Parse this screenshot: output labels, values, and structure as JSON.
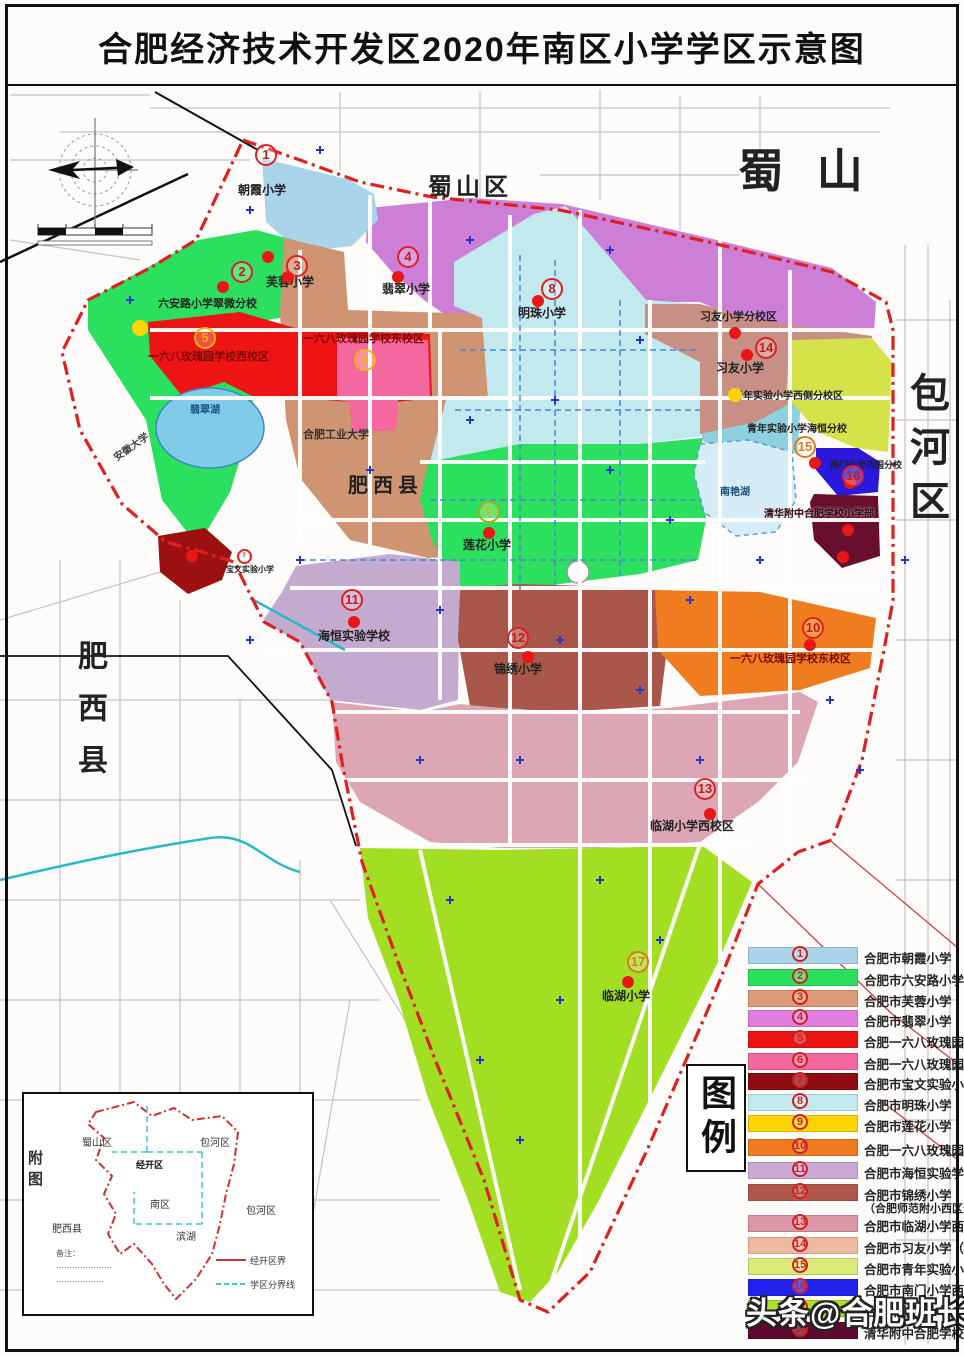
{
  "title": "合肥经济技术开发区2020年南区小学学区示意图",
  "watermark": "头条@合肥班长",
  "districts": {
    "shushan_center": "蜀山区",
    "shushan_big": "蜀 山",
    "baohe_vertical": "包河区",
    "feixi_vertical": "肥西县",
    "feixi_center": "肥西县"
  },
  "legend": {
    "box_label": "图例",
    "items": [
      {
        "num": 1,
        "color": "#a9d4ea",
        "name": "合肥市朝霞小学"
      },
      {
        "num": 2,
        "color": "#2be05e",
        "name": "合肥市六安路小学翠微分校"
      },
      {
        "num": 3,
        "color": "#dd9b79",
        "name": "合肥市芙蓉小学"
      },
      {
        "num": 4,
        "color": "#e07fdf",
        "name": "合肥市翡翠小学"
      },
      {
        "num": 5,
        "color": "#ee1414",
        "name": "合肥一六八玫瑰园学校西校区"
      },
      {
        "num": 6,
        "color": "#f4679f",
        "name": "合肥一六八玫瑰园学校东校区"
      },
      {
        "num": 7,
        "color": "#8e0b12",
        "name": "合肥市宝文实验小学"
      },
      {
        "num": 8,
        "color": "#c2e9ee",
        "name": "合肥市明珠小学"
      },
      {
        "num": 9,
        "color": "#ffd400",
        "name": "合肥市莲花小学"
      },
      {
        "num": 10,
        "color": "#f07b1e",
        "name": "合肥一六八玫瑰园学校东校区"
      },
      {
        "num": 11,
        "color": "#cbaad6",
        "name": "合肥市海恒实验学校"
      },
      {
        "num": 12,
        "color": "#b1564a",
        "name": "合肥市锦绣小学",
        "note": "（合肥师范附小西区分校）"
      },
      {
        "num": 13,
        "color": "#dd96a6",
        "name": "合肥市临湖小学西校区"
      },
      {
        "num": 14,
        "color": "#eeb9a2",
        "name": "合肥市习友小学（分校区）"
      },
      {
        "num": 15,
        "color": "#dcea7a",
        "name": "合肥市青年实验小学海恒分校区"
      },
      {
        "num": 16,
        "color": "#2222ee",
        "name": "合肥市南门小学西园分校"
      },
      {
        "num": 17,
        "color": "#abdf2b",
        "name": "合肥市临湖小学"
      },
      {
        "num": 18,
        "color": "#5d0a2e",
        "name": "清华附中合肥学校小学部"
      }
    ]
  },
  "map": {
    "labels": [
      {
        "text": "朝霞小学"
      },
      {
        "text": "六安路小学翠微分校"
      },
      {
        "text": "芙蓉小学"
      },
      {
        "text": "翡翠小学"
      },
      {
        "text": "一六八玫瑰园学校西校区"
      },
      {
        "text": "一六八玫瑰园学校东校区"
      },
      {
        "text": "明珠小学"
      },
      {
        "text": "习友小学分校区"
      },
      {
        "text": "习友小学"
      },
      {
        "text": "青年实验小学西侧分校区"
      },
      {
        "text": "青年实验小学海恒分校"
      },
      {
        "text": "莲花小学"
      },
      {
        "text": "南门小学西园分校"
      },
      {
        "text": "清华附中合肥学校小学部"
      },
      {
        "text": "海恒实验学校"
      },
      {
        "text": "锦绣小学"
      },
      {
        "text": "一六八玫瑰园学校东校区"
      },
      {
        "text": "临湖小学西校区"
      },
      {
        "text": "临湖小学"
      },
      {
        "text": "宝文实验小学"
      },
      {
        "text": "翡翠湖"
      },
      {
        "text": "南艳湖"
      },
      {
        "text": "合肥工业大学"
      },
      {
        "text": "安徽大学"
      }
    ]
  },
  "inset": {
    "labels": {
      "shushan": "蜀山区",
      "baohe_ne": "包河区",
      "jingkai": "经开区",
      "nanqu": "南区",
      "baohe_se": "包河区",
      "feixi": "肥西县",
      "binhu": "滨湖",
      "side": "附图"
    },
    "notes": [
      "备注：",
      "⋯⋯⋯⋯⋯⋯⋯",
      "⋯⋯⋯⋯⋯⋯"
    ],
    "legend": [
      {
        "label": "经开区界"
      },
      {
        "label": "学区分界线"
      }
    ]
  },
  "colors": {
    "boundary_red": "#e02020",
    "water_blue": "#7fcbe8",
    "road_gray": "#bdbdbd",
    "rail_black": "#111111",
    "stream_teal": "#28b8c8"
  }
}
